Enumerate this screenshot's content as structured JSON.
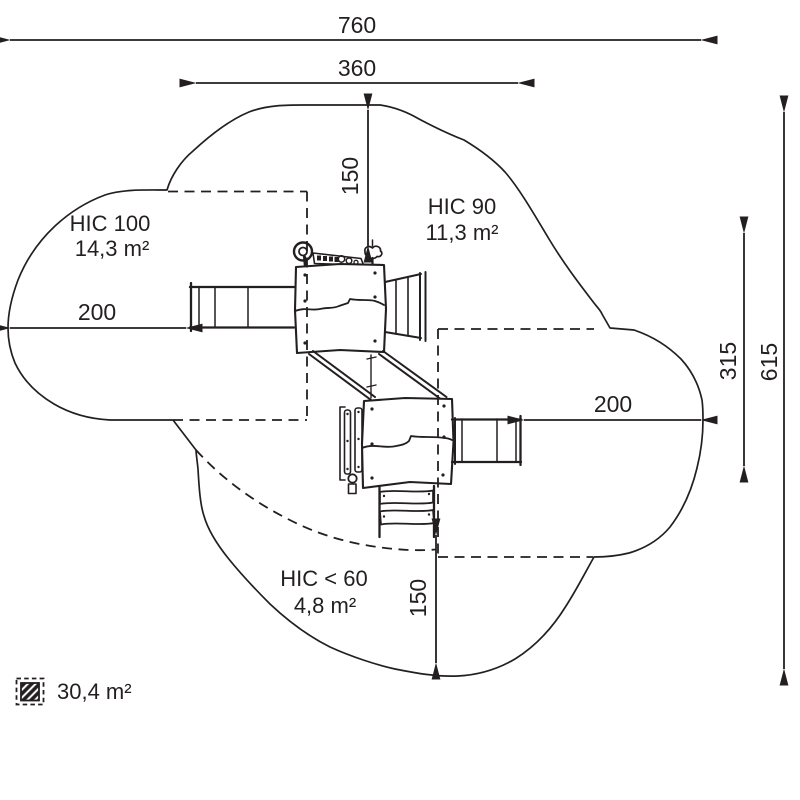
{
  "colors": {
    "ink": "#231f20",
    "background": "#ffffff"
  },
  "dimensions": {
    "total_width": "760",
    "upper_width": "360",
    "top_clearance": "150",
    "left_clearance": "200",
    "right_clearance": "200",
    "bottom_clearance": "150",
    "right_inner_span": "315",
    "right_total_span": "615"
  },
  "impact_zones": [
    {
      "name": "HIC 100",
      "area": "14,3 m²"
    },
    {
      "name": "HIC 90",
      "area": "11,3 m²"
    },
    {
      "name": "HIC < 60",
      "area": "4,8 m²"
    }
  ],
  "legend": {
    "icon": "hatched-square-icon",
    "total_area": "30,4 m²"
  }
}
